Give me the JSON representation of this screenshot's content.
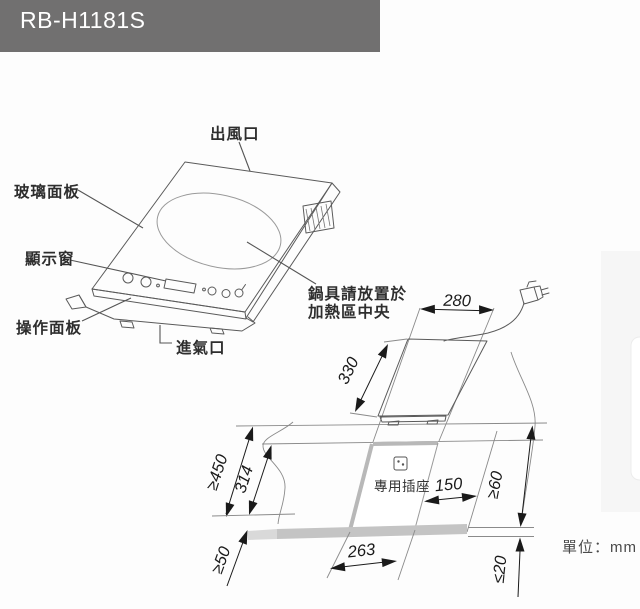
{
  "header": {
    "model": "RB-H1181S",
    "bg_color": "#717070",
    "text_color": "#ffffff"
  },
  "product": {
    "labels": {
      "air_outlet": "出風口",
      "glass_panel": "玻璃面板",
      "display_window": "顯示窗",
      "control_panel": "操作面板",
      "air_inlet": "進氣口",
      "pot_note_line1": "鍋具請放置於",
      "pot_note_line2": "加熱區中央"
    }
  },
  "install": {
    "dims": {
      "width": "280",
      "depth": "330",
      "counter_front_depth": "≥450",
      "cutout_depth": "314",
      "front_edge_min": "≥50",
      "socket_max_distance": "150",
      "side_min": "≥60",
      "counter_thickness_max": "≤20"
    },
    "socket_label": "專用插座",
    "unit_note": "單位：mm"
  },
  "colors": {
    "header_bg": "#717070",
    "line": "#5a5a5a",
    "dimension": "#1a1a1a",
    "counter_band": "#c4c4c4",
    "cutout_edge": "#b8b8b8",
    "side_panel": "#f6f6f6"
  }
}
